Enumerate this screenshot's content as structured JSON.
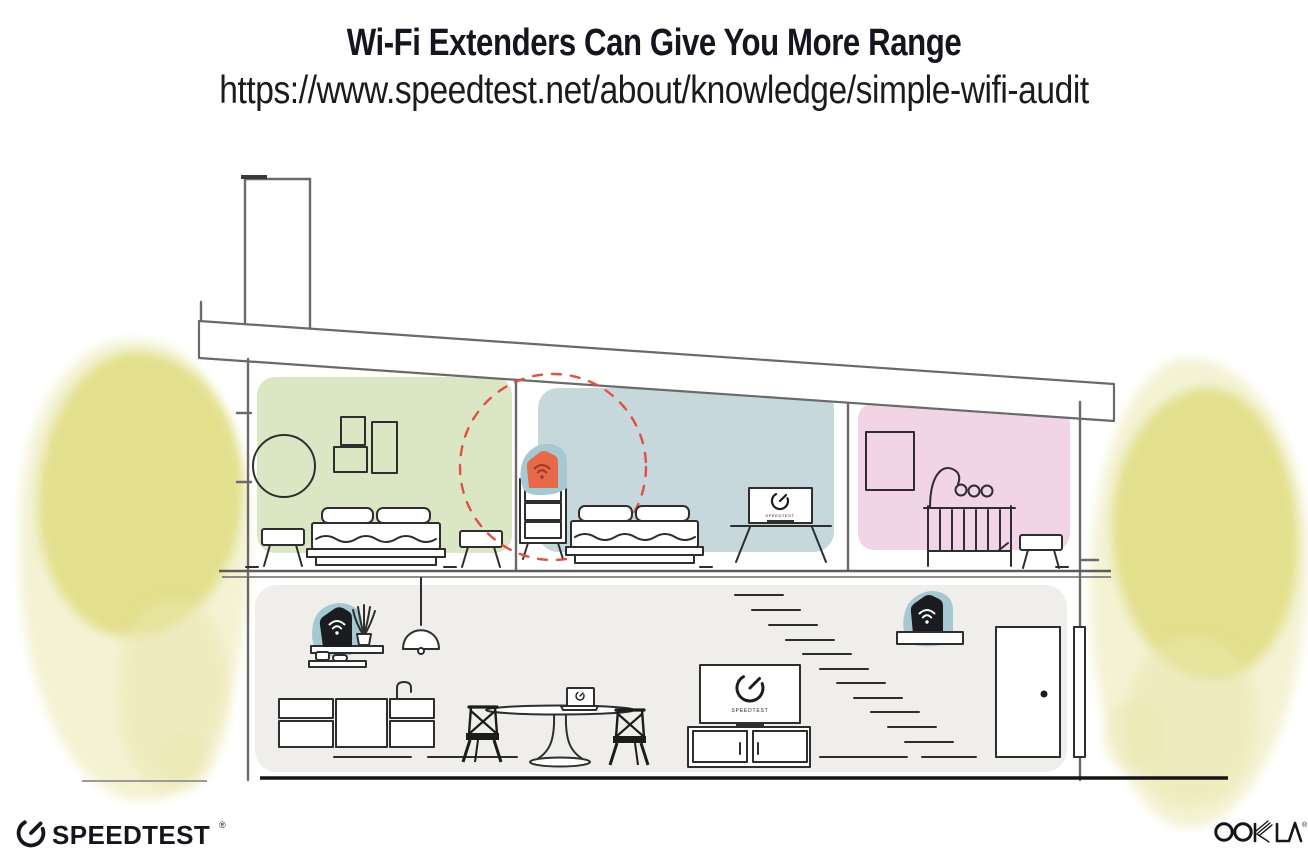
{
  "header": {
    "title": "Wi-Fi Extenders Can Give You More Range",
    "url": "https://www.speedtest.net/about/knowledge/simple-wifi-audit"
  },
  "illustration": {
    "tv_label": "SPEEDTEST",
    "rooms": [
      {
        "id": "bedroom-left",
        "color": "#dbe6c5"
      },
      {
        "id": "bedroom-middle",
        "color": "#c6d8db"
      },
      {
        "id": "nursery",
        "color": "#f1d4e6"
      },
      {
        "id": "living-area",
        "color": "#efeeeb"
      }
    ],
    "highlight_circle_color": "#df5140",
    "extender_color": "#e8684a",
    "device_halo_color": "#a5c8d1",
    "router_color": "#1b1c20",
    "watercolor_color": "#dfdc7e"
  },
  "footer": {
    "speedtest_wordmark": "SPEEDTEST",
    "speedtest_registered": "®",
    "ookla_wordmark": "OOKLA",
    "ookla_registered": "®",
    "brand_color": "#15161c"
  }
}
